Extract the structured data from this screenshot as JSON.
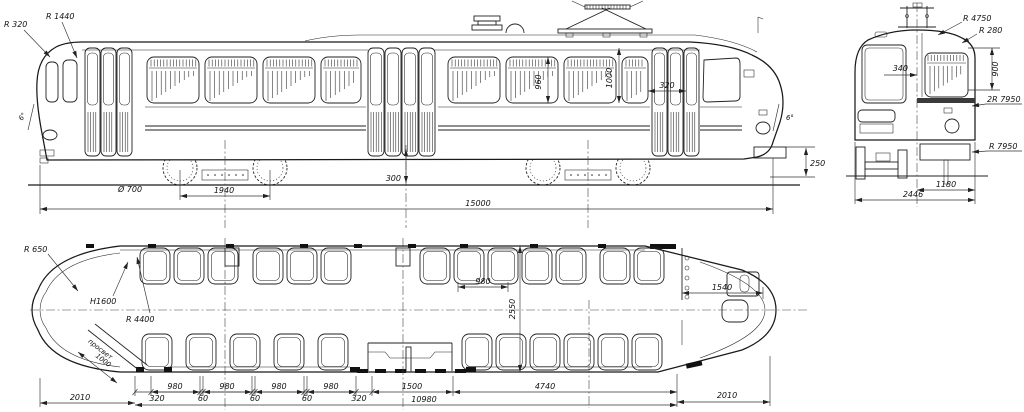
{
  "drawing": {
    "subject": "tram three-view dimensioned drawing",
    "side": {
      "r320": "R 320",
      "r1440": "R 1440",
      "angle_rear": "6°",
      "wheel_diameter": "Ø 700",
      "axle_base": "1940",
      "window_h1": "960",
      "window_h2": "1000",
      "vent_width": "320",
      "angle_front": "6°",
      "bumper_height": "250",
      "step_height": "300",
      "total_length": "15000"
    },
    "front": {
      "r4750": "R 4750",
      "r280": "R 280",
      "dim340": "340",
      "dim900": "900",
      "roof_radius": "2R 7950",
      "side_radius": "R 7950",
      "half_width": "1180",
      "width": "2446"
    },
    "plan": {
      "r650": "R 650",
      "h1600": "H1600",
      "r4400": "R 4400",
      "door_label": "просвет",
      "door_width": "1000",
      "seat_pitch": "980",
      "body_width": "2550",
      "cab_length": "1540",
      "rear_overhang": "2010",
      "chain": [
        "320",
        "980",
        "60",
        "980",
        "60",
        "980",
        "60",
        "980",
        "320"
      ],
      "mid_door": "1500",
      "seat_bay": "4740",
      "front_overhang": "2010",
      "doors_span": "10980"
    }
  }
}
